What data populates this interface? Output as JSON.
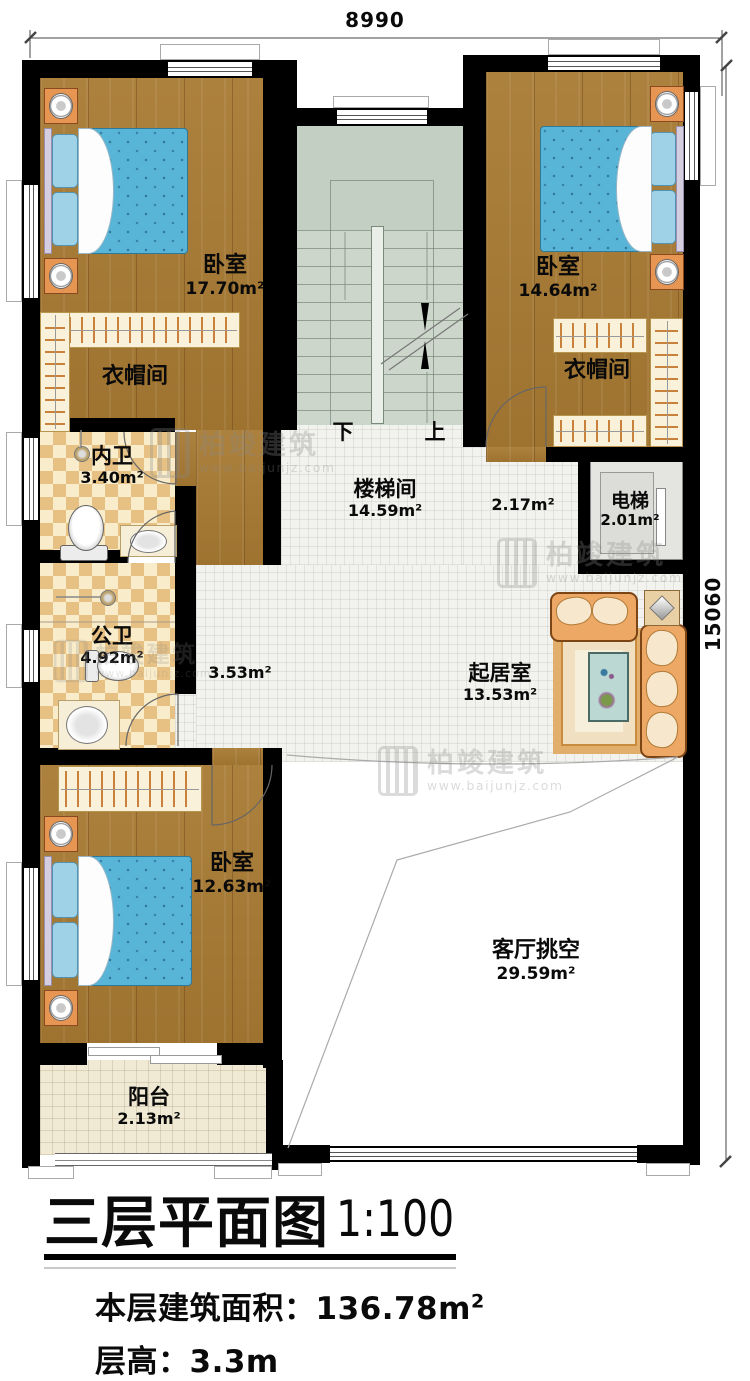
{
  "dimensions": {
    "width_mm": "8990",
    "height_mm": "15060"
  },
  "watermark": {
    "brand": "柏竣建筑",
    "site": "www.baijunjz.com"
  },
  "stair": {
    "down": "下",
    "up": "上"
  },
  "rooms": {
    "bedroom_tl": {
      "name": "卧室",
      "area": "17.70m²"
    },
    "bedroom_tr": {
      "name": "卧室",
      "area": "14.64m²"
    },
    "cloak_left": {
      "name": "衣帽间"
    },
    "cloak_right": {
      "name": "衣帽间"
    },
    "bath_inner": {
      "name": "内卫",
      "area": "3.40m²"
    },
    "stairwell": {
      "name": "楼梯间",
      "area": "14.59m²"
    },
    "hall_right": {
      "area": "2.17m²"
    },
    "elevator": {
      "name": "电梯",
      "area": "2.01m²"
    },
    "bath_public": {
      "name": "公卫",
      "area": "4.92m²"
    },
    "hall_left": {
      "area": "3.53m²"
    },
    "living": {
      "name": "起居室",
      "area": "13.53m²"
    },
    "bedroom_b": {
      "name": "卧室",
      "area": "12.63m²"
    },
    "void": {
      "name": "客厅挑空",
      "area": "29.59m²"
    },
    "balcony": {
      "name": "阳台",
      "area": "2.13m²"
    }
  },
  "title": {
    "main": "三层平面图",
    "scale": "1:100",
    "floor_area_label": "本层建筑面积：",
    "floor_area_value": "136.78m",
    "floor_area_sup": "2",
    "floor_height": "层高：3.3m"
  }
}
